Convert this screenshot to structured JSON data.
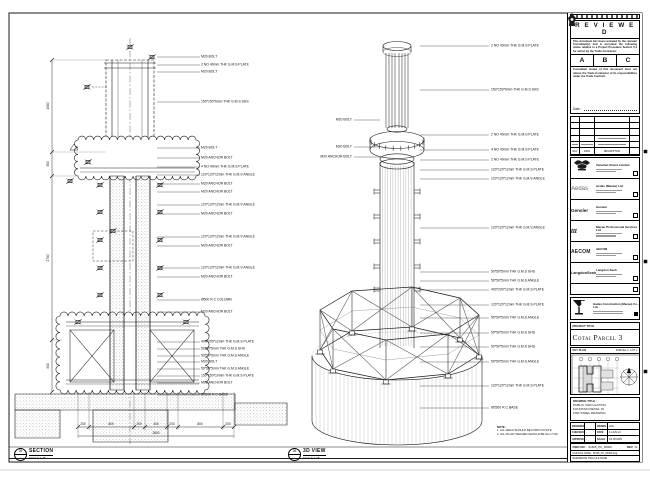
{
  "views": {
    "section": {
      "bubble_top": "05",
      "bubble_bottom": "-",
      "title": "SECTION",
      "scale": "SCALE 1:25",
      "labels": [
        {
          "y": 57,
          "text": "M20 BOLT"
        },
        {
          "y": 65,
          "text": "2 NO 40mm THK G.M.S PLATE"
        },
        {
          "y": 72,
          "text": "M20 BOLT"
        },
        {
          "y": 102,
          "text": "150*150*6mm THK G.M.S SHS"
        },
        {
          "y": 148,
          "text": "M20 BOLT"
        },
        {
          "y": 158,
          "text": "M20 ANCHOR BOLT"
        },
        {
          "y": 167,
          "text": "4 NO 40mm THK G.M.S PLATE"
        },
        {
          "y": 175,
          "text": "120*120*12mm THK G.M.S ANGLE"
        },
        {
          "y": 184,
          "text": "M20 ANCHOR BOLT"
        },
        {
          "y": 192,
          "text": "M20 ANCHOR BOLT"
        },
        {
          "y": 205,
          "text": "120*120*12mm THK G.M.S ANGLE"
        },
        {
          "y": 214,
          "text": "M20 ANCHOR BOLT"
        },
        {
          "y": 237,
          "text": "120*120*12mm THK G.M.S ANGLE"
        },
        {
          "y": 246,
          "text": "M20 ANCHOR BOLT"
        },
        {
          "y": 268,
          "text": "120*120*12mm THK G.M.S ANGLE"
        },
        {
          "y": 277,
          "text": "M20 ANCHOR BOLT"
        },
        {
          "y": 300,
          "text": "Ø500 R.C COLUMN"
        },
        {
          "y": 312,
          "text": "M20 ANCHOR BOLT"
        },
        {
          "y": 342,
          "text": "400*200*12mm THK G.M.S PLATE"
        },
        {
          "y": 349,
          "text": "50*50*5mm THK G.M.S SHS"
        },
        {
          "y": 356,
          "text": "50*50*5mm THK G.M.S ANGLE"
        },
        {
          "y": 362,
          "text": "M20 BOLT"
        },
        {
          "y": 369,
          "text": "50*50*5mm THK G.M.S ANGLE"
        },
        {
          "y": 376,
          "text": "150*150*10mm THK G.M.S PLATE"
        },
        {
          "y": 383,
          "text": "M20 ANCHOR BOLT"
        },
        {
          "y": 395,
          "text": "Ø2500 R.C BASE"
        }
      ],
      "dims_bottom": [
        {
          "x": 83,
          "y": 426,
          "text": "200"
        },
        {
          "x": 111,
          "y": 426,
          "text": "800"
        },
        {
          "x": 139,
          "y": 426,
          "text": "200"
        },
        {
          "x": 156,
          "y": 426,
          "text": "400"
        },
        {
          "x": 172,
          "y": 426,
          "text": "200"
        },
        {
          "x": 200,
          "y": 426,
          "text": "800"
        },
        {
          "x": 228,
          "y": 426,
          "text": "200"
        }
      ],
      "dim_total": [
        {
          "x": 156,
          "y": 435,
          "text": "2800"
        }
      ],
      "dims_left": [
        {
          "x": 48,
          "y": 106,
          "text": "1500"
        },
        {
          "x": 48,
          "y": 164,
          "text": "300"
        },
        {
          "x": 48,
          "y": 258,
          "text": "2700"
        },
        {
          "x": 48,
          "y": 366,
          "text": "900"
        }
      ]
    },
    "iso": {
      "bubble_top": "06",
      "bubble_bottom": "-",
      "title": "3D VIEW",
      "scale": "SCALE 1:25",
      "labels_right": [
        {
          "y": 46,
          "text": "2 NO 40mm THK G.M.S PLATE"
        },
        {
          "y": 90,
          "text": "150*150*6mm THK G.M.S SHS"
        },
        {
          "y": 135,
          "text": "2 NO 40mm THK G.M.S PLATE"
        },
        {
          "y": 150,
          "text": "4 NO 40mm THK G.M.S PLATE"
        },
        {
          "y": 160,
          "text": "2 NO 40mm THK G.M.S PLATE"
        },
        {
          "y": 170,
          "text": "120*120*12mm THK G.M.S PLATE"
        },
        {
          "y": 179,
          "text": "120*120*12mm THK G.M.S ANGLE"
        },
        {
          "y": 228,
          "text": "120*120*12mm THK G.M.S ANGLE"
        },
        {
          "y": 272,
          "text": "50*50*5mm THK G.M.S SHS"
        },
        {
          "y": 281,
          "text": "50*50*5mm THK G.M.S ANGLE"
        },
        {
          "y": 290,
          "text": "400*200*12mm THK G.M.S PLATE"
        },
        {
          "y": 305,
          "text": "120*120*12mm THK G.M.S PLATE"
        },
        {
          "y": 318,
          "text": "50*50*5mm THK G.M.S ANGLE"
        },
        {
          "y": 333,
          "text": "50*50*5mm THK G.M.S SHS"
        },
        {
          "y": 347,
          "text": "50*50*5mm THK G.M.S SHS"
        },
        {
          "y": 362,
          "text": "50*50*5mm THK G.M.S ANGLE"
        },
        {
          "y": 386,
          "text": "120*120*12mm THK G.M.S PLATE"
        },
        {
          "y": 408,
          "text": "Ø2500 R.C BASE"
        }
      ],
      "labels_left": [
        {
          "y": 120,
          "text": "M20 BOLT"
        },
        {
          "y": 147,
          "text": "M20 BOLT"
        },
        {
          "y": 157,
          "text": "M20 ANCHOR BOLT"
        }
      ]
    }
  },
  "notes": {
    "heading": "NOTE :",
    "items": [
      "1. ALL WELD SHOULD BE FORM ON SITE.",
      "2. ALL FILLET WELDED SHOULD BE 6mm THK."
    ]
  },
  "stamp": {
    "title": "R E V I E W E D",
    "body1": "This document has been reviewed by the relevant Consultant(s) and is accorded the following status relative to a Project Procedure Section 5.4 for action by the Trade Contractor.",
    "options": [
      "A",
      "B",
      "C"
    ],
    "body2": "Consultant review of this document does not relieve the Trade Contractor of its responsibilities under the Trade Contract.",
    "date_label": "Date :"
  },
  "revision_table": {
    "headers": [
      "REV",
      "DATE",
      "DESCRIPTION"
    ]
  },
  "consultants": [
    {
      "logo": "",
      "name": "Venetian Orient Limited"
    },
    {
      "logo": "Aedas",
      "name": "Aedas (Macau) Ltd."
    },
    {
      "logo": "Gensler",
      "name": "Gensler"
    },
    {
      "logo": "ttt",
      "name": "Macau Professional Services Ltd."
    },
    {
      "logo": "AECOM",
      "name": "AECOM"
    },
    {
      "logo": "LangdonSeah",
      "name": "Langdon Seah"
    }
  ],
  "contractor": {
    "name": "Hadao Construction (Macau) Co., Ltd."
  },
  "project": {
    "header": "PROJECT TITLE",
    "name": "Cotai Parcel 3"
  },
  "key_plan": {
    "header": "KEY PLAN",
    "parcel": "PARCEL 1, LOT 2"
  },
  "title_block": {
    "drawing_title_header": "DRAWING TITLE :",
    "title_lines": [
      "PUBLIC CIRCULATION,",
      "FOUNTAIN DETAIL IN",
      "FOR STEEL DRAWING"
    ],
    "fields": {
      "designed_label": "DESIGNED",
      "designed": "",
      "drawn_label": "DRAWN",
      "drawn": "LEO",
      "checked_label": "CHECKED",
      "checked": "-",
      "date_label": "DATE",
      "date": "14-JUN-10",
      "approved_label": "APPROVED",
      "approved": "-",
      "scale_label": "SCALE",
      "scale": "AS SHOWN"
    },
    "dwg_no_label": "DWG NO :",
    "dwg_no": "51525_PC_00000",
    "rev": "REV : C",
    "cad_label": "CAD FILE NAME : 51525_PC_00000.dwg",
    "ref_label": "REFERENCE DWG FILE NAME :"
  }
}
